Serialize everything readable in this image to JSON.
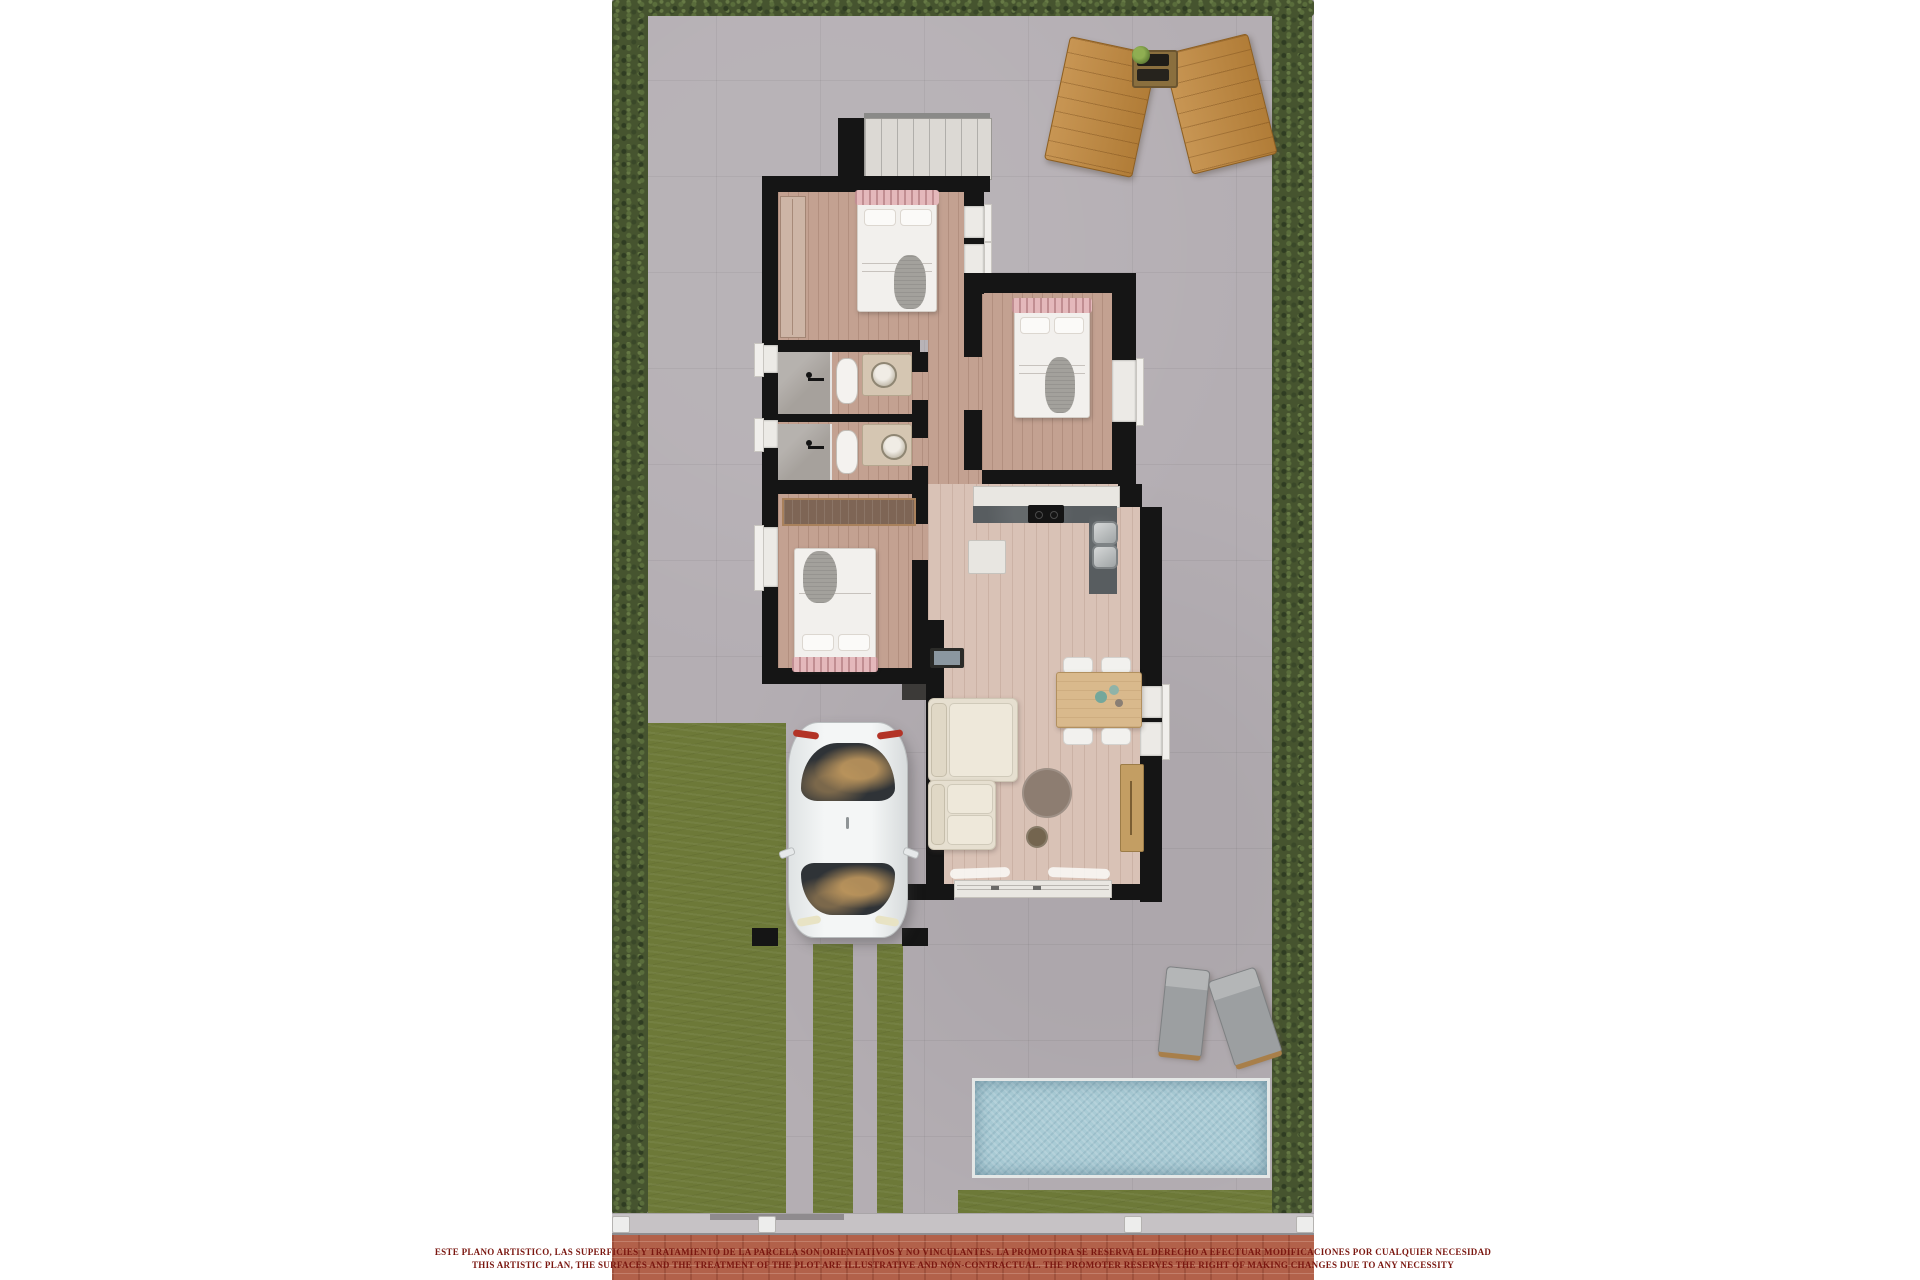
{
  "banner": {
    "line1": "ESTE PLANO ARTISTICO, LAS SUPERFICIES Y TRATAMIENTO DE LA PARCELA SON ORIENTATIVOS Y NO VINCULANTES. LA PROMOTORA SE RESERVA EL DERECHO A EFECTUAR MODIFICACIONES POR CUALQUIER NECESIDAD",
    "line2": "THIS ARTISTIC PLAN, THE SURFACES AND THE TREATMENT OF THE PLOT ARE ILLUSTRATIVE AND NON-CONTRACTUAL. THE PROMOTER RESERVES THE RIGHT OF MAKING CHANGES DUE TO ANY NECESSITY"
  },
  "colors": {
    "background": "#ffffff",
    "paving": "#b4aeb3",
    "hedge_green": "#46542f",
    "lawn_green": "#6d7938",
    "pool_water": "#a9cbd5",
    "wall_black": "#151515",
    "bedroom_floor": "#c3a191",
    "living_floor": "#d9c2b6",
    "marble_white": "#e9e7e2",
    "kitchen_counter": "#585d60",
    "bed_headboard_pink": "#e4b8bb",
    "sofa_cream": "#e6dfd0",
    "lounger_wood": "#c0873c",
    "banner_brick": "#b2614a",
    "banner_text": "#7a1710",
    "car_body": "#eceff0"
  }
}
